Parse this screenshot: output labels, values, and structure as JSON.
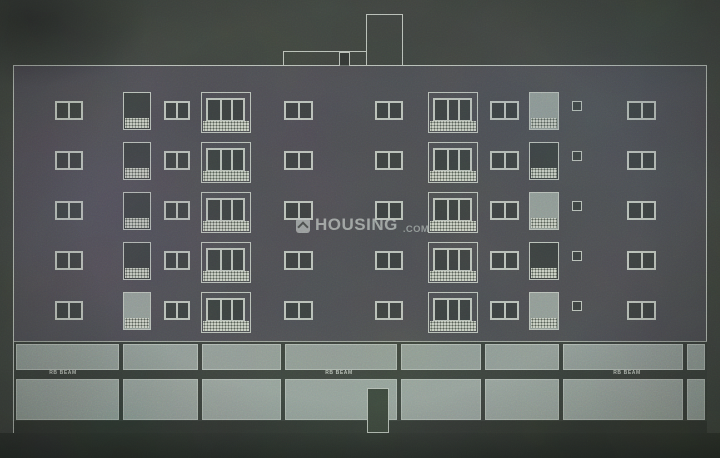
{
  "watermark": {
    "brand": "HOUSING",
    "tld": ".COM",
    "logo_icon": "chevron-up-icon"
  },
  "ground": {
    "beam_labels": [
      "RB BEAM",
      "RB BEAM",
      "RB BEAM"
    ],
    "beam_label_centers_x": [
      63,
      339,
      627
    ],
    "divider_edges_local": [
      0,
      107,
      186,
      269,
      385,
      469,
      547,
      671,
      693
    ],
    "upper_panel": {
      "top": 2,
      "height": 26
    },
    "lower_panel": {
      "top": 37,
      "height": 41
    },
    "door": {
      "left": 353,
      "top": 46,
      "width": 22,
      "height": 45
    }
  },
  "elevation": {
    "floors": 5,
    "row_window_tops": [
      101,
      151,
      201,
      251,
      301
    ],
    "window_height": 19,
    "balcony_rise": 9,
    "columns": [
      {
        "type": "window2",
        "x": 55,
        "w": 28
      },
      {
        "type": "balcony-narrow",
        "x": 123,
        "w": 28,
        "light_rows": [
          5
        ]
      },
      {
        "type": "window2",
        "x": 164,
        "w": 26
      },
      {
        "type": "balcony-wide",
        "x": 201,
        "w": 50
      },
      {
        "type": "window2",
        "x": 284,
        "w": 29
      },
      {
        "type": "window2",
        "x": 375,
        "w": 28
      },
      {
        "type": "balcony-wide",
        "x": 428,
        "w": 50
      },
      {
        "type": "window2",
        "x": 490,
        "w": 29
      },
      {
        "type": "balcony-narrow",
        "x": 529,
        "w": 30,
        "light_rows": [
          1,
          3,
          5
        ]
      },
      {
        "type": "window-small",
        "x": 572,
        "w": 10
      },
      {
        "type": "window2",
        "x": 627,
        "w": 29
      }
    ],
    "roof": {
      "step": {
        "x": 283,
        "top": 51,
        "width": 84
      },
      "tower": {
        "x": 366,
        "top": 14,
        "width": 37
      },
      "access_door": {
        "x": 339,
        "top": 52,
        "width": 11
      }
    },
    "outline": {
      "left": 13,
      "top": 65,
      "right": 707,
      "ground_line_y": 433
    }
  },
  "colors": {
    "sky": "#3f443f",
    "facade": "#4a4a4f",
    "line": "#b7beb6",
    "glass": "#3b403f",
    "hatch": "#c6ccc0",
    "panel": "#8f9a94",
    "panel_lower": "#96a19b",
    "band_dark": "#3a403b",
    "base_dark": "#2c312c",
    "door": "#384037",
    "label_color": "#c6cdc5",
    "watermark_color": "#b9c0bb"
  }
}
